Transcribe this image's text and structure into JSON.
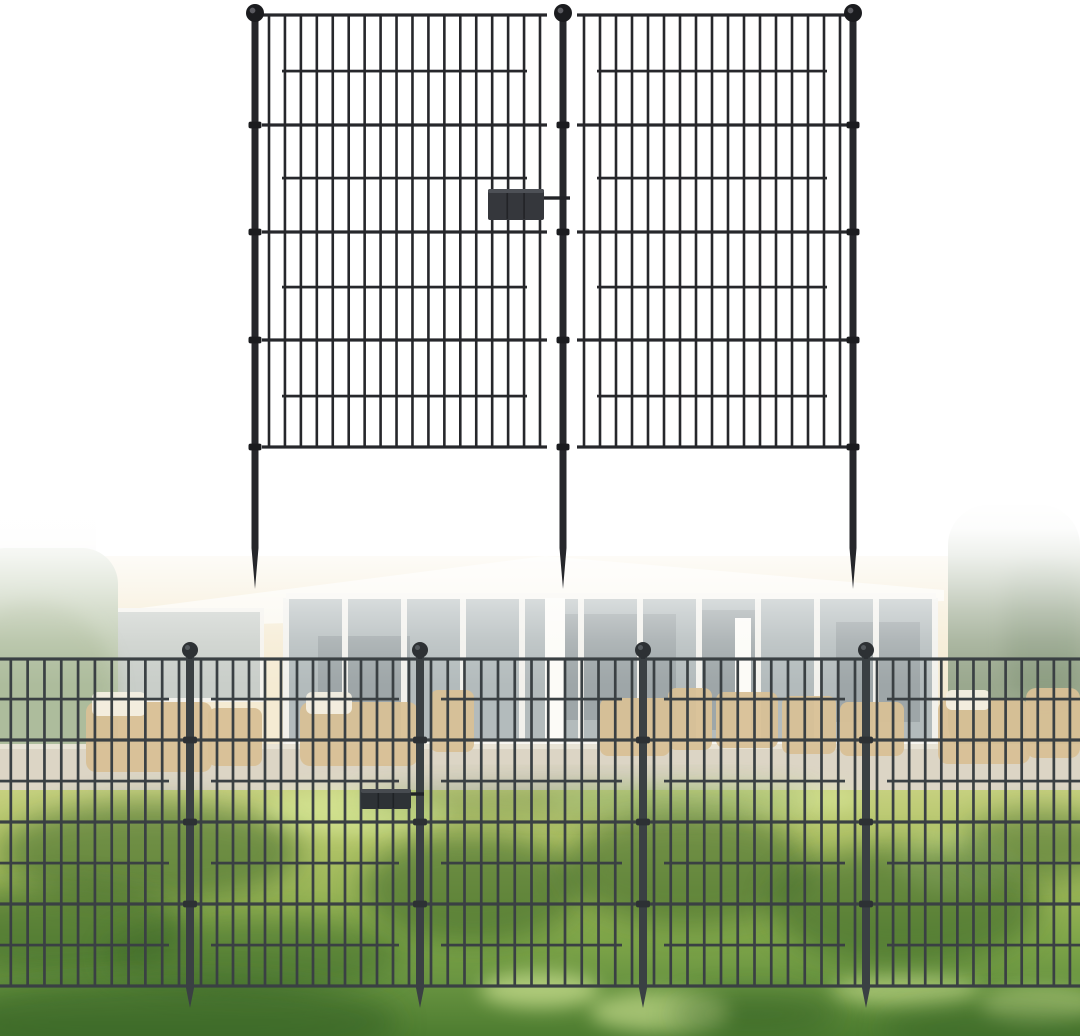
{
  "image": {
    "alt": "Two black metal garden fence panels with ground stakes shown on white, above a faded backyard photo of the same decorative no-dig fence installed on a sunny lawn in front of a patio house",
    "background": "#ffffff",
    "width": 1080,
    "height": 1036
  },
  "product_render": {
    "color": "#26272b",
    "color_dark": "#1b1c1f",
    "ball_highlight": "#6a6a70",
    "posts_x": [
      255,
      563,
      853
    ],
    "post_width": 7,
    "post_top": 14,
    "ball": {
      "cy": 13,
      "r": 9
    },
    "panels": [
      {
        "x1": 262,
        "x2": 547
      },
      {
        "x1": 577,
        "x2": 847
      }
    ],
    "grid_top": 15,
    "grid_bottom": 447,
    "full_rails": [
      15,
      125,
      232,
      340,
      447
    ],
    "inset_rails": [
      71,
      178,
      287,
      396
    ],
    "inset_margin": 20,
    "bar_margin": 7,
    "bar_spacing": 16.3,
    "bar_width": 2.6,
    "rail_width": 3.2,
    "stake_taper_start": 548,
    "stake_tip_y": 589,
    "collar_rails": [
      125,
      232,
      340,
      447
    ],
    "clip": {
      "x": 488,
      "y": 189,
      "w": 56,
      "h": 31,
      "pin_y": 198,
      "pin_x2": 570,
      "fill": "#35373c",
      "edge": "#4d5056",
      "seam": "#222327"
    }
  },
  "installed_fence": {
    "color": "#3a4043",
    "color_dark": "#2d3134",
    "ball_highlight": "#5c6366",
    "posts_x": [
      190,
      420,
      643,
      866
    ],
    "post_width": 8,
    "post_top": 655,
    "ball": {
      "cy": 650,
      "r": 8
    },
    "left_edge": -8,
    "right_edge": 1088,
    "grid_top": 659,
    "grid_bottom": 986,
    "full_rails": [
      659,
      740,
      822,
      904,
      986
    ],
    "inset_rails": [
      699,
      781,
      863,
      945
    ],
    "inset_margin": 21,
    "bar_margin": 11,
    "bar_spacing": 16.6,
    "bar_width": 2.7,
    "rail_width": 3.2,
    "stake_taper_start": 988,
    "stake_tip_y": 1008,
    "collar_rails": [
      740,
      822,
      904
    ],
    "clip": {
      "x": 361,
      "y": 789,
      "w": 50,
      "h": 20,
      "pin_y": 794,
      "pin_x2": 424,
      "fill": "#2e3236",
      "edge": "#474b50",
      "seam": "#1f2225"
    }
  },
  "backyard": {
    "photo_top": 500,
    "wash_stops": [
      [
        0,
        1
      ],
      [
        0.09,
        0.97
      ],
      [
        0.17,
        0.84
      ],
      [
        0.26,
        0.62
      ],
      [
        0.35,
        0.38
      ],
      [
        0.44,
        0.18
      ],
      [
        0.52,
        0.06
      ],
      [
        0.58,
        0
      ]
    ],
    "house_wall": {
      "x": 78,
      "y": 556,
      "w": 886,
      "h": 238,
      "fill": "#f5ebd3"
    },
    "roof_fascia": {
      "points": "78,616 545,556 944,590 944,601 78,630",
      "fill": "#fbf8ef"
    },
    "left_building": {
      "x": 0,
      "y": 505,
      "w": 96,
      "h": 72,
      "fill": "#e9e7e1",
      "opacity": 0.55
    },
    "glass_wall": {
      "x": 286,
      "y": 598,
      "w": 650,
      "h": 146,
      "fill": "#b3bbbc",
      "mullion_step": 59,
      "mullion_fill": "#f2f1ec",
      "frame_fill": "#f7f5ef"
    },
    "glass_shadows": [
      {
        "x": 318,
        "y": 636,
        "w": 92,
        "h": 84
      },
      {
        "x": 556,
        "y": 614,
        "w": 120,
        "h": 106
      },
      {
        "x": 700,
        "y": 610,
        "w": 56,
        "h": 120
      },
      {
        "x": 836,
        "y": 622,
        "w": 84,
        "h": 100
      }
    ],
    "glass_shadow_fill": "#8d9698",
    "left_window": {
      "x": 92,
      "y": 612,
      "w": 168,
      "h": 86,
      "fill": "#c9cec9",
      "frame": "#f4f2ec"
    },
    "columns": [
      {
        "x": 545,
        "y": 598,
        "w": 20,
        "h": 196
      },
      {
        "x": 735,
        "y": 618,
        "w": 16,
        "h": 158
      }
    ],
    "column_fill": "#fcfbf7",
    "hedge": {
      "x": -30,
      "y": 548,
      "w": 148,
      "h": 244,
      "rx": 36,
      "fill": "#bcc8ad",
      "inner": {
        "cx": 34,
        "cy": 692,
        "rx": 82,
        "ry": 92,
        "fill": "#a8b795"
      }
    },
    "tree": {
      "x": 948,
      "y": 505,
      "w": 132,
      "h": 258,
      "rx": 40,
      "fill": "#9aa88e",
      "inner": {
        "x": 1006,
        "y": 556,
        "w": 74,
        "h": 140,
        "rx": 30,
        "fill": "#8a9b7f"
      },
      "bush": {
        "x": 1035,
        "y": 690,
        "w": 45,
        "h": 72,
        "rx": 18,
        "fill": "#93a489"
      }
    },
    "path": {
      "x": 0,
      "y": 744,
      "w": 1080,
      "h": 50,
      "fill": "#dcd5c5",
      "edge_fill": "#e8e3d5"
    },
    "furniture_tan": "#d8c096",
    "furniture_white": "#f4efe2",
    "furniture": [
      {
        "x": 86,
        "y": 702,
        "w": 126,
        "h": 70,
        "rx": 10,
        "tone": "tan"
      },
      {
        "x": 92,
        "y": 692,
        "w": 54,
        "h": 24,
        "rx": 6,
        "tone": "white"
      },
      {
        "x": 208,
        "y": 708,
        "w": 54,
        "h": 58,
        "rx": 8,
        "tone": "tan"
      },
      {
        "x": 300,
        "y": 702,
        "w": 118,
        "h": 64,
        "rx": 10,
        "tone": "tan"
      },
      {
        "x": 306,
        "y": 692,
        "w": 46,
        "h": 22,
        "rx": 6,
        "tone": "white"
      },
      {
        "x": 430,
        "y": 690,
        "w": 44,
        "h": 62,
        "rx": 8,
        "tone": "tan"
      },
      {
        "x": 600,
        "y": 698,
        "w": 70,
        "h": 58,
        "rx": 8,
        "tone": "tan"
      },
      {
        "x": 668,
        "y": 688,
        "w": 44,
        "h": 62,
        "rx": 8,
        "tone": "tan"
      },
      {
        "x": 716,
        "y": 692,
        "w": 62,
        "h": 56,
        "rx": 8,
        "tone": "tan"
      },
      {
        "x": 782,
        "y": 696,
        "w": 54,
        "h": 58,
        "rx": 8,
        "tone": "tan"
      },
      {
        "x": 840,
        "y": 702,
        "w": 64,
        "h": 54,
        "rx": 8,
        "tone": "tan"
      },
      {
        "x": 938,
        "y": 700,
        "w": 92,
        "h": 64,
        "rx": 10,
        "tone": "tan"
      },
      {
        "x": 1026,
        "y": 688,
        "w": 54,
        "h": 70,
        "rx": 10,
        "tone": "tan"
      },
      {
        "x": 946,
        "y": 690,
        "w": 44,
        "h": 20,
        "rx": 6,
        "tone": "white"
      }
    ],
    "lawn": {
      "y": 790,
      "h": 246,
      "gradient": [
        [
          0,
          "#c6d07f"
        ],
        [
          0.2,
          "#b2c468"
        ],
        [
          0.45,
          "#95b254"
        ],
        [
          0.62,
          "#7da448"
        ],
        [
          0.78,
          "#699441"
        ],
        [
          1,
          "#4d7c30"
        ]
      ]
    },
    "shadow_fill": "#2f5a22",
    "shadows": [
      {
        "cx": 150,
        "cy": 852,
        "rx": 150,
        "ry": 50,
        "o": 0.5
      },
      {
        "cx": 60,
        "cy": 930,
        "rx": 130,
        "ry": 45,
        "o": 0.5
      },
      {
        "cx": 255,
        "cy": 955,
        "rx": 150,
        "ry": 38,
        "o": 0.4
      },
      {
        "cx": 472,
        "cy": 888,
        "rx": 110,
        "ry": 55,
        "o": 0.5
      },
      {
        "cx": 688,
        "cy": 868,
        "rx": 125,
        "ry": 58,
        "o": 0.5
      },
      {
        "cx": 905,
        "cy": 905,
        "rx": 135,
        "ry": 60,
        "o": 0.5
      },
      {
        "cx": 1040,
        "cy": 845,
        "rx": 80,
        "ry": 35,
        "o": 0.45
      },
      {
        "cx": 585,
        "cy": 800,
        "rx": 230,
        "ry": 16,
        "o": 0.3
      },
      {
        "cx": 170,
        "cy": 1022,
        "rx": 230,
        "ry": 42,
        "o": 0.5
      },
      {
        "cx": 755,
        "cy": 1014,
        "rx": 85,
        "ry": 22,
        "o": 0.45
      },
      {
        "cx": 1000,
        "cy": 1028,
        "rx": 120,
        "ry": 26,
        "o": 0.4
      }
    ],
    "highlight_fill": "#dff0a0",
    "highlights": [
      {
        "cx": 355,
        "cy": 812,
        "rx": 95,
        "ry": 22,
        "o": 0.55
      },
      {
        "cx": 705,
        "cy": 800,
        "rx": 160,
        "ry": 18,
        "o": 0.5
      },
      {
        "cx": 955,
        "cy": 862,
        "rx": 60,
        "ry": 30,
        "o": 0.4
      },
      {
        "cx": 540,
        "cy": 990,
        "rx": 60,
        "ry": 18,
        "o": 0.6
      },
      {
        "cx": 660,
        "cy": 1012,
        "rx": 70,
        "ry": 20,
        "o": 0.55
      },
      {
        "cx": 905,
        "cy": 990,
        "rx": 75,
        "ry": 16,
        "o": 0.5
      },
      {
        "cx": 1040,
        "cy": 1005,
        "rx": 60,
        "ry": 18,
        "o": 0.45
      }
    ]
  }
}
